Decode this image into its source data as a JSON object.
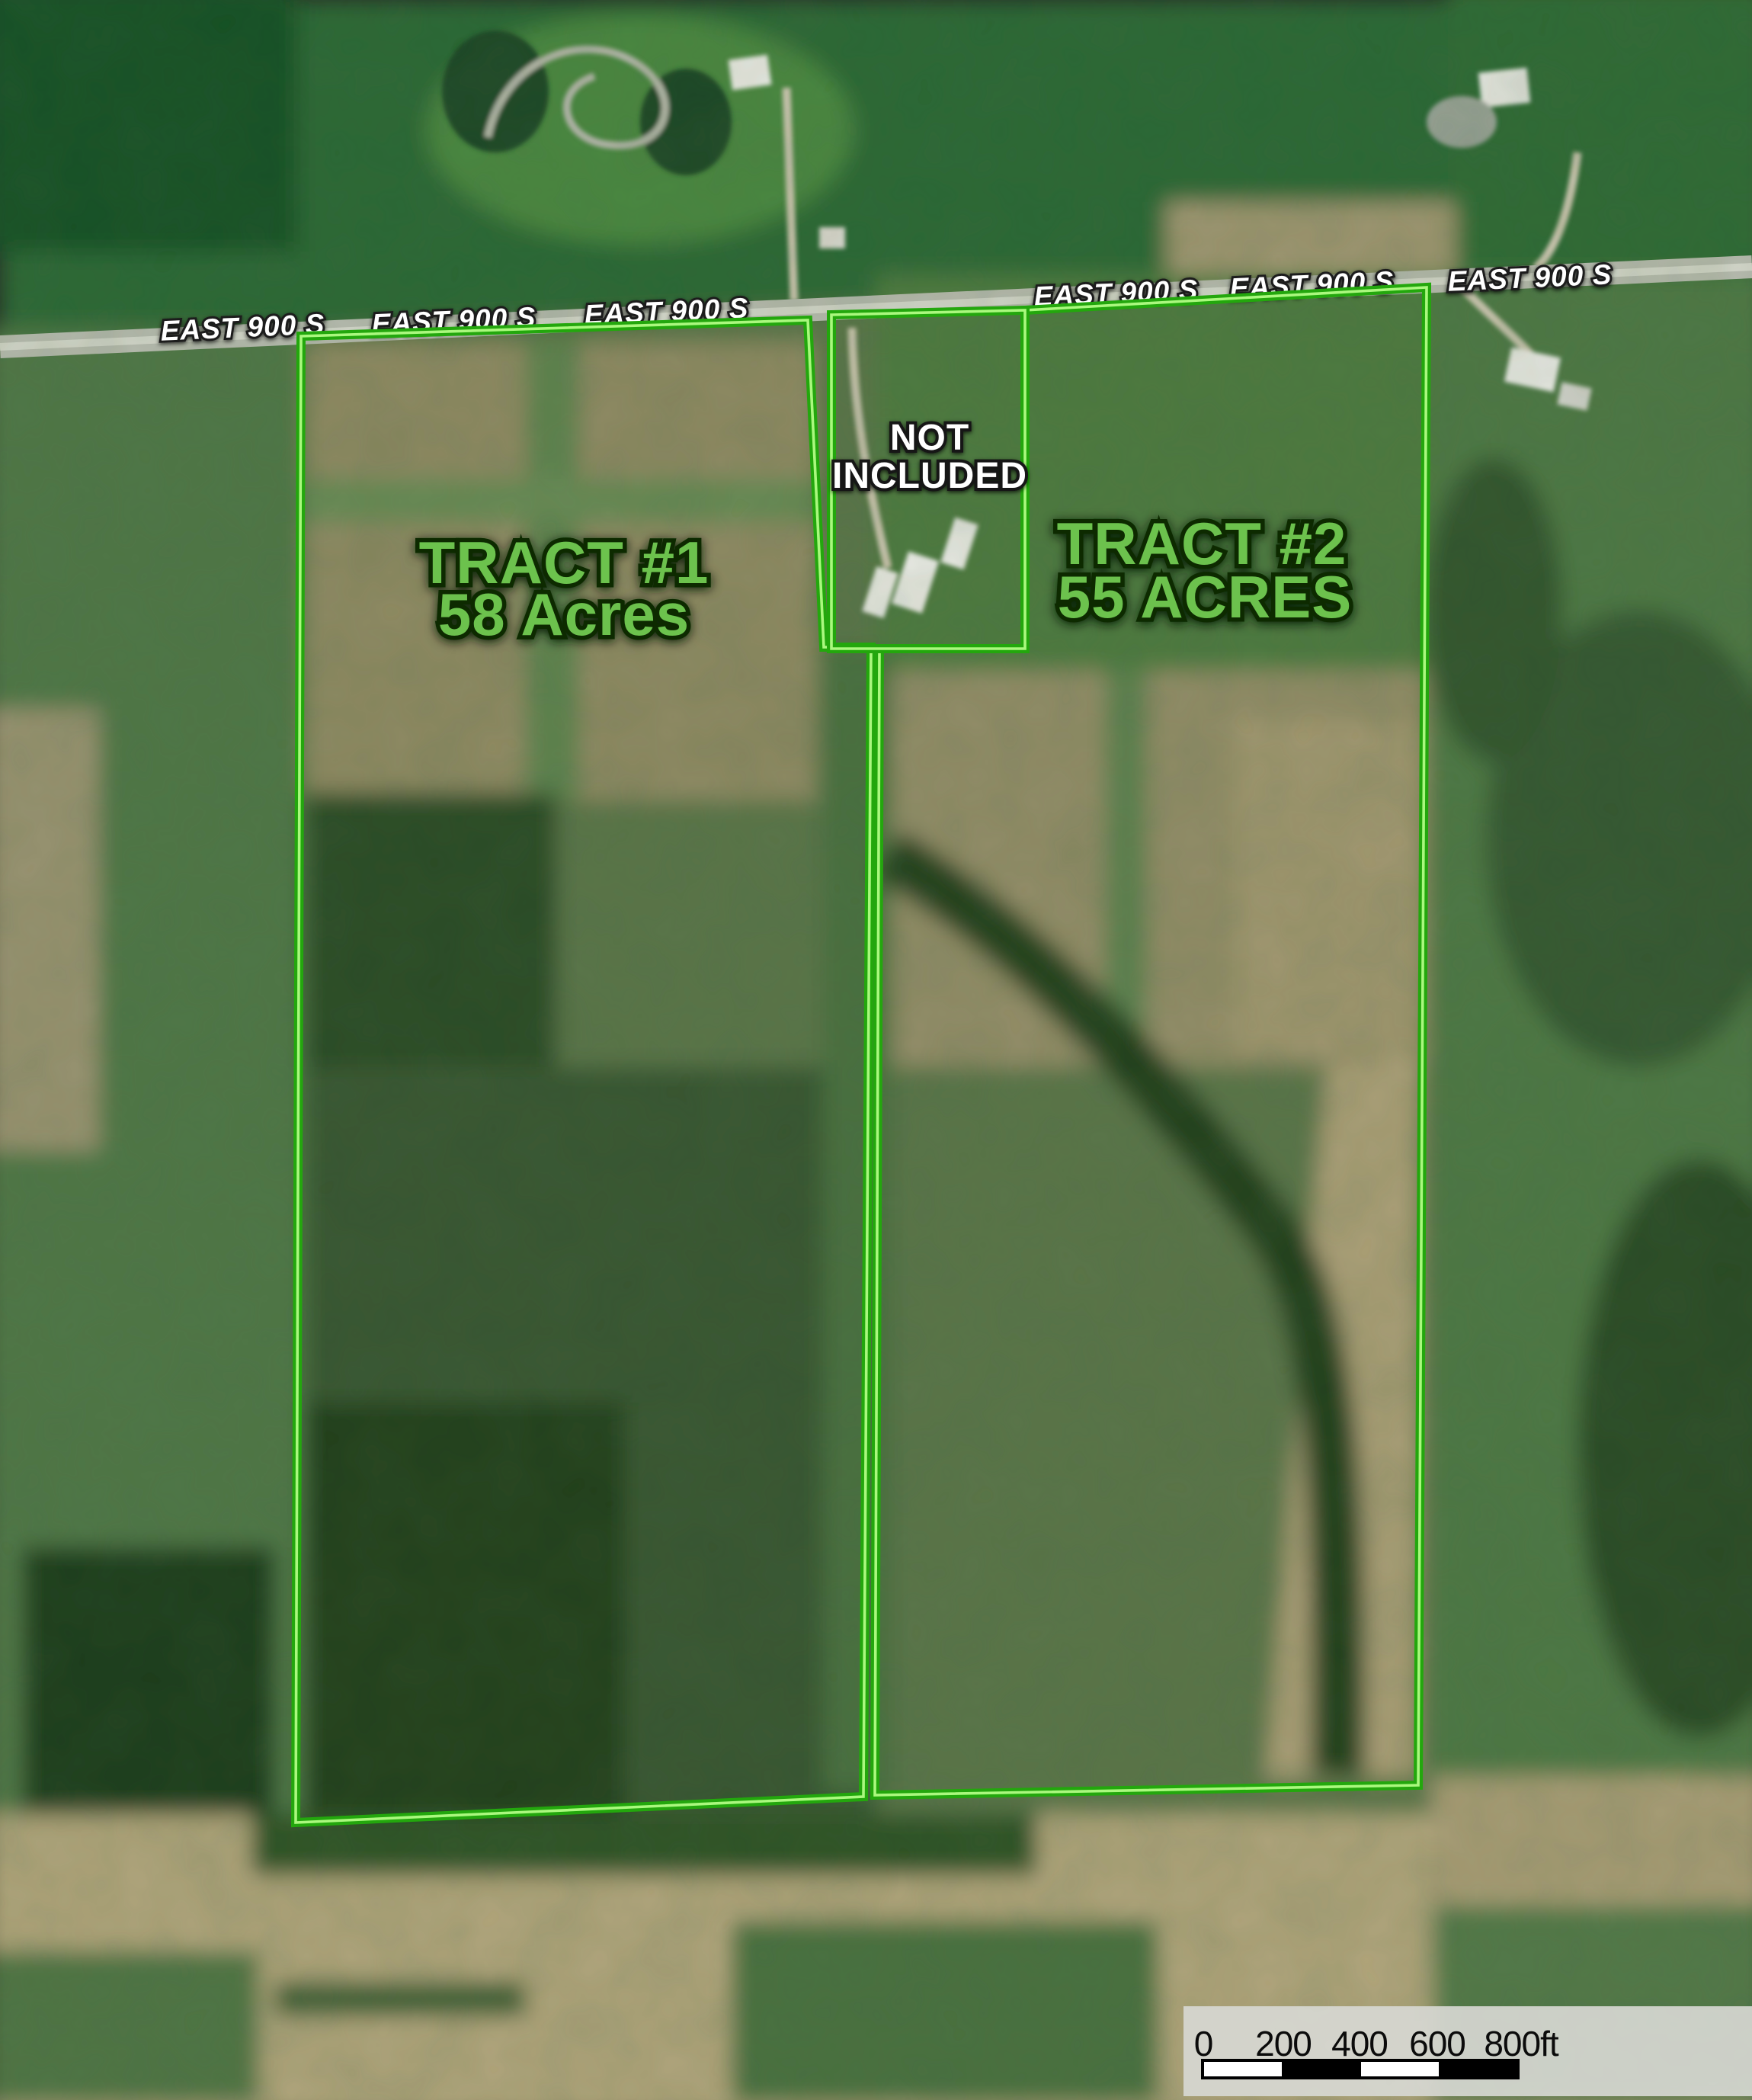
{
  "map": {
    "road_name": "EAST 900 S",
    "road_label_instances": 6,
    "tracts": [
      {
        "name": "TRACT #1",
        "acreage": "58 Acres"
      },
      {
        "name": "TRACT #2",
        "acreage": "55 ACRES"
      }
    ],
    "excluded_parcel": {
      "label_line1": "NOT",
      "label_line2": "INCLUDED"
    },
    "colors": {
      "boundary_green": "#23a70d",
      "boundary_core": "#aaf87e",
      "tract_label_green": "#6cc24e",
      "road_label_white": "#ffffff",
      "road_gray": "#b6baae",
      "scale_panel_gray": "#d7d8d3"
    }
  },
  "scale_bar": {
    "ticks": [
      "0",
      "200",
      "400",
      "600",
      "800ft"
    ],
    "segment_ft": 200,
    "max_label": "800ft"
  }
}
